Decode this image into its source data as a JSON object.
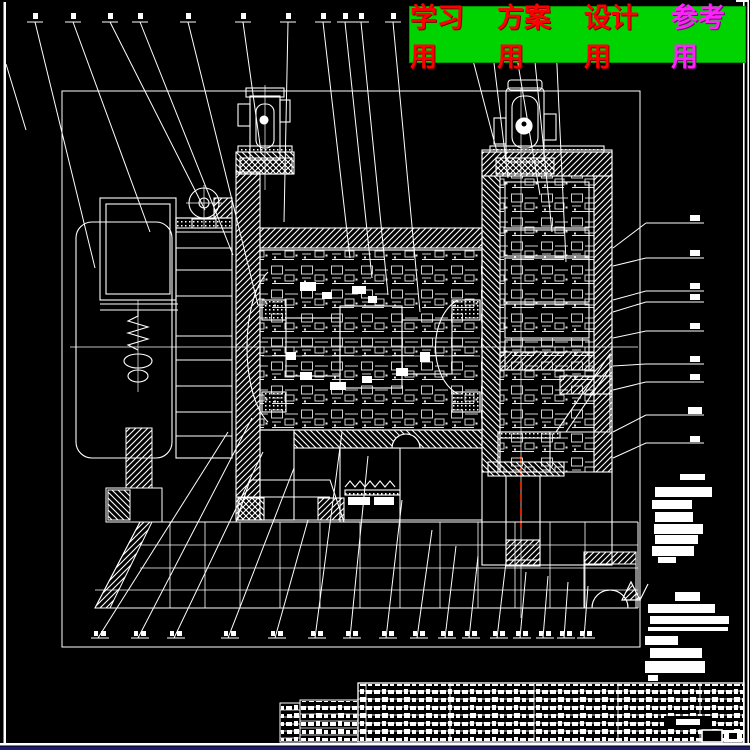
{
  "banner": {
    "background": "#00d400",
    "items": [
      {
        "label": "学习用",
        "color": "#ff0000"
      },
      {
        "label": "方案用",
        "color": "#ff0000"
      },
      {
        "label": "设计用",
        "color": "#ff0000"
      },
      {
        "label": "参考用",
        "color": "#ff22ff"
      }
    ]
  },
  "canvas": {
    "background": "#000000",
    "line_color": "#ffffff",
    "accent_centerline_color": "#ff3300",
    "bottom_strip_color": "#1b1b70"
  },
  "drawing": {
    "content": "gear reducer assembly cross-section",
    "top_leader_ticks": "16",
    "bottom_leader_ticks": "16",
    "right_leader_ticks": "9"
  },
  "title_block": {
    "legible_text": "",
    "rows": "8"
  }
}
